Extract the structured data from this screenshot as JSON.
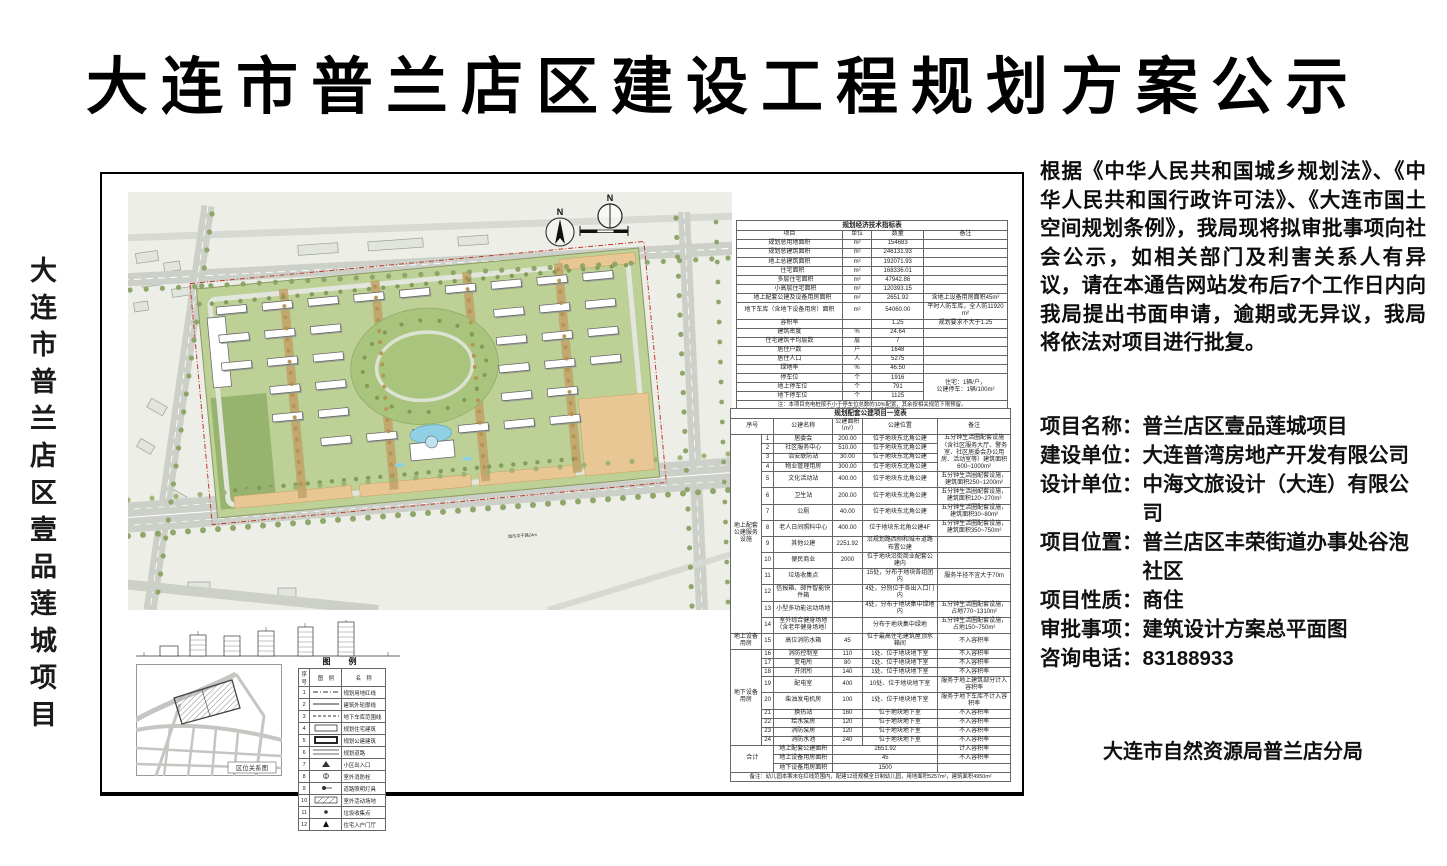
{
  "title": "大连市普兰店区建设工程规划方案公示",
  "side_label": "大连市普兰店区壹品莲城项目",
  "notice": "根据《中华人民共和国城乡规划法》、《中华人民共和国行政许可法》、《大连市国土空间规划条例》，我局现将拟审批事项向社会公示，如相关部门及利害关系人有异议，请在本通告网站发布后7个工作日内向我局提出书面申请，逾期或无异议，我局将依法对项目进行批复。",
  "project_fields": [
    {
      "label": "项目名称：",
      "value": "普兰店区壹品莲城项目"
    },
    {
      "label": "建设单位：",
      "value": "大连普湾房地产开发有限公司"
    },
    {
      "label": "设计单位：",
      "value": "中海文旅设计（大连）有限公司"
    },
    {
      "label": "项目位置：",
      "value": "普兰店区丰荣街道办事处谷泡社区"
    },
    {
      "label": "项目性质：",
      "value": "商住"
    },
    {
      "label": "审批事项：",
      "value": "建筑设计方案总平面图"
    },
    {
      "label": "咨询电话：",
      "value": "83188933"
    }
  ],
  "authority": "大连市自然资源局普兰店分局",
  "plan": {
    "north_label": "N",
    "road_label": "城市次干路24m",
    "map_caption": "区位关系图"
  },
  "indicators_table": {
    "title": "规划经济技术指标表",
    "headers": [
      "项目",
      "单位",
      "数量",
      "备注"
    ],
    "rows": [
      {
        "name": "规划总用地面积",
        "unit": "m²",
        "value": "154683",
        "note": "",
        "indent": 0
      },
      {
        "name": "规划总建筑面积",
        "unit": "m²",
        "value": "246131.93",
        "note": "",
        "indent": 0
      },
      {
        "name": "地上总建筑面积",
        "unit": "m²",
        "value": "192071.93",
        "note": "",
        "indent": 0
      },
      {
        "name": "住宅面积",
        "unit": "m²",
        "value": "168336.01",
        "note": "",
        "indent": 1
      },
      {
        "name": "多层住宅面积",
        "unit": "m²",
        "value": "47942.86",
        "note": "",
        "indent": 2
      },
      {
        "name": "小高层住宅面积",
        "unit": "m²",
        "value": "120393.15",
        "note": "",
        "indent": 2
      },
      {
        "name": "地上配套公建及设备用房面积",
        "unit": "m²",
        "value": "2651.92",
        "note": "含地上设备用房面积45m²",
        "indent": 1
      },
      {
        "name": "地下车库（含地下设备用房）面积",
        "unit": "m²",
        "value": "54060.00",
        "note": "平时人防车库，全人防11920m²",
        "indent": 0
      },
      {
        "name": "容积率",
        "unit": "",
        "value": "1.25",
        "note": "规划要求不大于1.25",
        "indent": 0
      },
      {
        "name": "建筑密度",
        "unit": "%",
        "value": "24.64",
        "note": "",
        "indent": 0
      },
      {
        "name": "住宅建筑平均层数",
        "unit": "层",
        "value": "7",
        "note": "",
        "indent": 0
      },
      {
        "name": "居住户数",
        "unit": "户",
        "value": "1648",
        "note": "",
        "indent": 0
      },
      {
        "name": "居住人口",
        "unit": "人",
        "value": "5275",
        "note": "",
        "indent": 0
      },
      {
        "name": "绿地率",
        "unit": "%",
        "value": "46.50",
        "note": "",
        "indent": 0
      },
      {
        "name": "停车位",
        "unit": "个",
        "value": "1916",
        "note": "住宅：1辆/户，\n公建停车：1辆/100m²",
        "noteRows": 3,
        "indent": 0
      },
      {
        "name": "地上停车位",
        "unit": "个",
        "value": "791",
        "note": null,
        "indent": 1
      },
      {
        "name": "地下停车位",
        "unit": "个",
        "value": "1125",
        "note": null,
        "indent": 1
      }
    ],
    "note": "注：本项目充电桩按不小于停车位总数的10%配置，其余按相关规范下限预留。\n人防建设面积为地上总建筑面积的6%。"
  },
  "facilities_table": {
    "title": "规划配套公建项目一览表",
    "headers": [
      "序号",
      "公建名称",
      "公建面积（m²）",
      "公建位置",
      "备注"
    ],
    "rows": [
      {
        "cat": "地上配套公建服务设施",
        "catRows": 14,
        "no": "1",
        "name": "居委会",
        "area": "200.00",
        "pos": "位于地块东北角公建",
        "note": "五分钟生活圈配套设施（含社区服务大厅、警务室、社区居委会办公用房、活动室等）建筑面积600~1000m²",
        "noteRows": 4
      },
      {
        "no": "2",
        "name": "社区服务中心",
        "area": "510.00",
        "pos": "位于地块东北角公建",
        "note": null
      },
      {
        "no": "3",
        "name": "治安联防站",
        "area": "30.00",
        "pos": "位于地块东北角公建",
        "note": null
      },
      {
        "no": "4",
        "name": "物业管理用房",
        "area": "300.00",
        "pos": "位于地块东北角公建",
        "note": null
      },
      {
        "no": "5",
        "name": "文化活动站",
        "area": "400.00",
        "pos": "位于地块东北角公建",
        "note": "五分钟生活圈配套设施，建筑面积250~1200m²"
      },
      {
        "no": "6",
        "name": "卫生站",
        "area": "200.00",
        "pos": "位于地块东北角公建",
        "note": "五分钟生活圈配套设施，建筑面积120~270m²"
      },
      {
        "no": "7",
        "name": "公厕",
        "area": "40.00",
        "pos": "位于地块东北角公建",
        "note": "五分钟生活圈配套设施，建筑面积30~80m²"
      },
      {
        "no": "8",
        "name": "老人日间照料中心",
        "area": "400.00",
        "pos": "位于地块东北角公建4F",
        "note": "五分钟生活圈配套设施，建筑面积350~750m²"
      },
      {
        "no": "9",
        "name": "其他公建",
        "area": "2251.92",
        "pos": "沿规划路西侧和城市道路布置公建",
        "note": ""
      },
      {
        "no": "10",
        "name": "便民商业",
        "area": "2000",
        "pos": "位于地块沿街商业配套公建内",
        "note": ""
      },
      {
        "no": "11",
        "name": "垃圾收集点",
        "area": "",
        "pos": "15处，分布于地块各组团内",
        "note": "服务半径不宜大于70m"
      },
      {
        "no": "12",
        "name": "信报箱、邮件智能快件箱",
        "area": "",
        "pos": "4处，分别位于各出入口门内",
        "note": ""
      },
      {
        "no": "13",
        "name": "小型多功能运动场地",
        "area": "",
        "pos": "4处，分布于地块集中绿地内",
        "note": "五分钟生活圈配套设施，占地770~1310m²"
      },
      {
        "no": "14",
        "name": "室外综合健身场地（含老年健身场地）",
        "area": "",
        "pos": "分布于地块集中绿地",
        "note": "五分钟生活圈配套设施，占地150~750m²"
      },
      {
        "cat": "地上设备用房",
        "catRows": 1,
        "no": "15",
        "name": "高位消防水箱",
        "area": "45",
        "pos": "位于最高住宅建筑屋顶水箱间",
        "note": "不入容积率"
      },
      {
        "cat": "地下设备用房",
        "catRows": 9,
        "no": "16",
        "name": "消防控制室",
        "area": "110",
        "pos": "1处、位于地块地下室",
        "note": "不入容积率"
      },
      {
        "no": "17",
        "name": "变电所",
        "area": "80",
        "pos": "1处、位于地块地下室",
        "note": "不入容积率"
      },
      {
        "no": "18",
        "name": "开闭所",
        "area": "140",
        "pos": "1处、位于地块地下室",
        "note": "不入容积率"
      },
      {
        "no": "19",
        "name": "配电室",
        "area": "400",
        "pos": "10处、位于地块地下室",
        "note": "服务于地上建筑部分计入容积率"
      },
      {
        "no": "20",
        "name": "柴油发电机房",
        "area": "100",
        "pos": "1处、位于地块地下室",
        "note": "服务于地下车库不计入容积率"
      },
      {
        "no": "21",
        "name": "换热站",
        "area": "160",
        "pos": "位于地块地下室",
        "note": "不入容积率"
      },
      {
        "no": "22",
        "name": "给水泵房",
        "area": "120",
        "pos": "位于地块地下室",
        "note": "不入容积率"
      },
      {
        "no": "23",
        "name": "消防泵房",
        "area": "120",
        "pos": "位于地块地下室",
        "note": "不入容积率"
      },
      {
        "no": "24",
        "name": "消防水池",
        "area": "240",
        "pos": "位于地块地下室",
        "note": "不入容积率"
      }
    ],
    "total_label": "合计",
    "totals": [
      {
        "label": "地上配套公建面积",
        "value": "2651.92",
        "note": "计入容积率"
      },
      {
        "label": "地上设备用房面积",
        "value": "45",
        "note": "不入容积率"
      },
      {
        "label": "地下设备用房面积",
        "value": "1500",
        "note": ""
      }
    ],
    "note": "备注：幼儿园本案未在红线范围内，配建12班规模全日制幼儿园，用地面积5257m²，建筑面积4950m²"
  },
  "legend": {
    "title": "图　例",
    "headers": [
      "序号",
      "图　例",
      "名　称"
    ],
    "rows": [
      {
        "no": "1",
        "sym": "dashdot",
        "name": "规划用地红线"
      },
      {
        "no": "2",
        "sym": "solid",
        "name": "建筑外轮廓线"
      },
      {
        "no": "3",
        "sym": "dash",
        "name": "地下车库范围线"
      },
      {
        "no": "4",
        "sym": "res",
        "name": "规划住宅建筑"
      },
      {
        "no": "5",
        "sym": "pub",
        "name": "规划公建建筑"
      },
      {
        "no": "6",
        "sym": "road",
        "name": "规划道路"
      },
      {
        "no": "7",
        "sym": "arrow",
        "name": "小区出入口"
      },
      {
        "no": "8",
        "sym": "hydrant",
        "name": "室外消防栓"
      },
      {
        "no": "9",
        "sym": "lamp",
        "name": "道路照明灯具"
      },
      {
        "no": "10",
        "sym": "hatch",
        "name": "室外活动场地"
      },
      {
        "no": "11",
        "sym": "dot",
        "name": "垃圾收集点"
      },
      {
        "no": "12",
        "sym": "entry",
        "name": "住宅入户门厅"
      }
    ]
  }
}
